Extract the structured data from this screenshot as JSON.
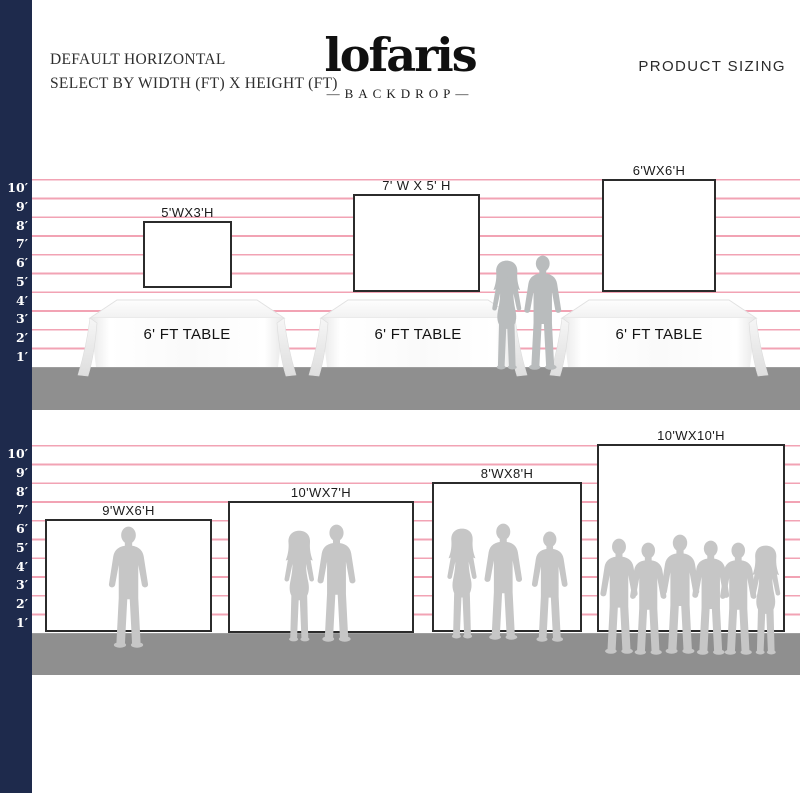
{
  "header": {
    "subtitle_line1": "DEFAULT HORIZONTAL",
    "subtitle_line2": "SELECT BY WIDTH (FT) X HEIGHT (FT)",
    "brand": "lofaris",
    "brand_sub": "—BACKDROP—",
    "right_title": "PRODUCT SIZING"
  },
  "ruler": {
    "labels": [
      "10′",
      "9′",
      "8′",
      "7′",
      "6′",
      "5′",
      "4′",
      "3′",
      "2′",
      "1′"
    ]
  },
  "top_section": {
    "backdrops": [
      {
        "label": "5'WX3'H"
      },
      {
        "label": "7' W X 5' H"
      },
      {
        "label": "6'WX6'H"
      }
    ],
    "table_label": "6' FT TABLE"
  },
  "bottom_section": {
    "backdrops": [
      {
        "label": "9'WX6'H"
      },
      {
        "label": "10'WX7'H"
      },
      {
        "label": "8'WX8'H"
      },
      {
        "label": "10'WX10'H"
      }
    ]
  },
  "colors": {
    "navy": "#1e2a4c",
    "grid_pink": "#f2a3b4",
    "floor_gray": "#8f8f8f",
    "silhouette_gray": "#c6c6c6",
    "border_dark": "#2b2b2b"
  }
}
